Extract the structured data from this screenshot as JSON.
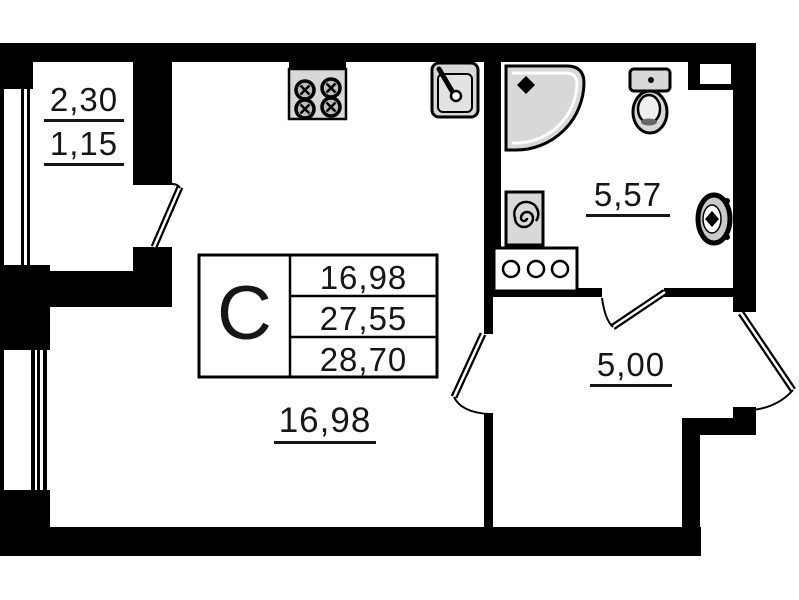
{
  "labels": {
    "balcony_area_full": "2,30",
    "balcony_area_reduced": "1,15",
    "bathroom_area": "5,57",
    "hallway_area": "5,00",
    "living_area": "16,98"
  },
  "summary_table": {
    "unit_type": "С",
    "rows": [
      "16,98",
      "27,55",
      "28,70"
    ]
  },
  "colors": {
    "wall": "#000000",
    "fixture_fill": "#d8d8d8",
    "background": "#ffffff"
  },
  "fixtures": {
    "stove": "stove-icon",
    "kitchen_sink": "sink-icon",
    "shower": "shower-icon",
    "toilet": "toilet-icon",
    "washing_machine": "washing-machine-icon",
    "cabinet": "cabinet-icon",
    "washbasin": "washbasin-icon"
  }
}
